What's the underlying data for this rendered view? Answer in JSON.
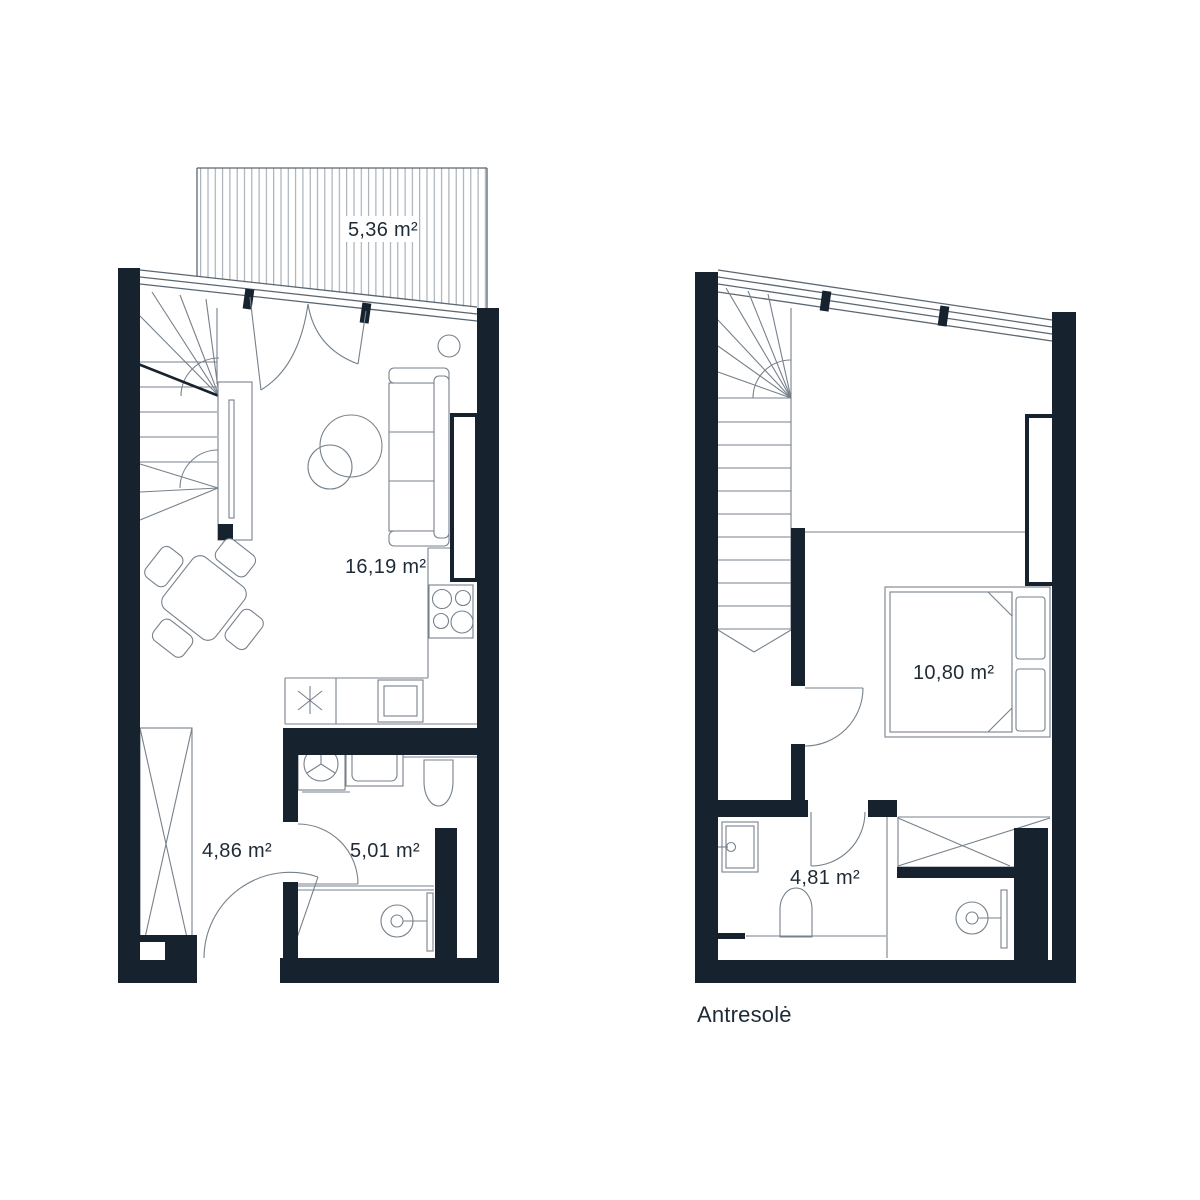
{
  "colors": {
    "wall": "#16222e",
    "structure_line": "#5a6772",
    "furniture_line": "#76818b",
    "hatch_line": "#99a2ab",
    "text": "#1e2a36",
    "background": "#ffffff"
  },
  "floors": {
    "ground": {
      "rooms": {
        "terrace": {
          "area_label": "5,36 m²"
        },
        "living_kitchen": {
          "area_label": "16,19 m²"
        },
        "hall": {
          "area_label": "4,86 m²"
        },
        "bathroom": {
          "area_label": "5,01 m²"
        }
      }
    },
    "mezzanine": {
      "floor_name": "Antresolė",
      "rooms": {
        "bedroom": {
          "area_label": "10,80 m²"
        },
        "bathroom": {
          "area_label": "4,81 m²"
        }
      }
    }
  }
}
